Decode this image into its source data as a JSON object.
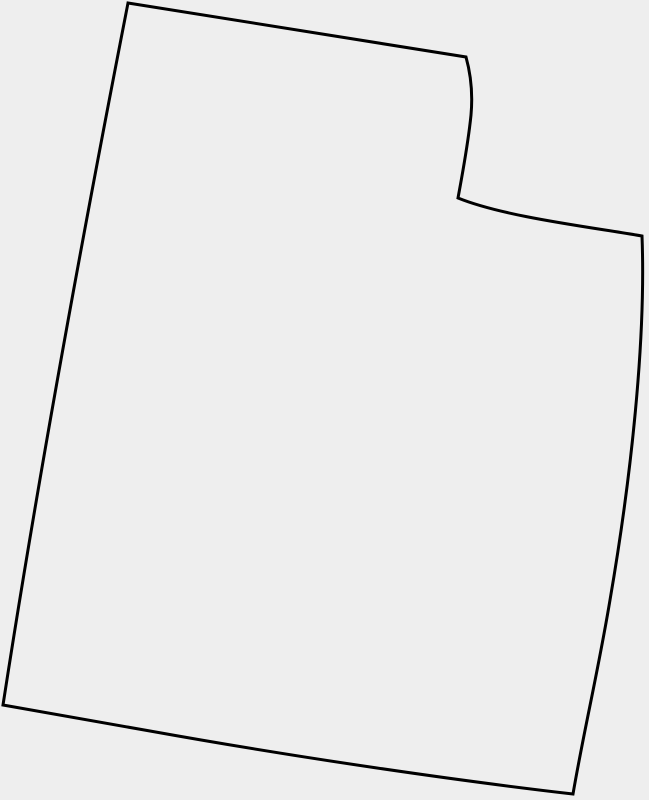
{
  "map": {
    "shape_name": "utah-state-outline",
    "background_color": "#eeeeee",
    "stroke_color": "#000000",
    "stroke_width": 3,
    "fill_color": "#eeeeee",
    "outline_path": "M 128,3 L 466,57 C 471,75 473,93 471,115 C 468,145 462,176 458,198 C 505,217 590,227 642,236 C 646,340 631,478 610,600 C 598,672 584,730 573,794 C 460,781 300,758 150,731 C 100,722 50,713 3,705 C 30,530 70,300 128,3 Z"
  }
}
